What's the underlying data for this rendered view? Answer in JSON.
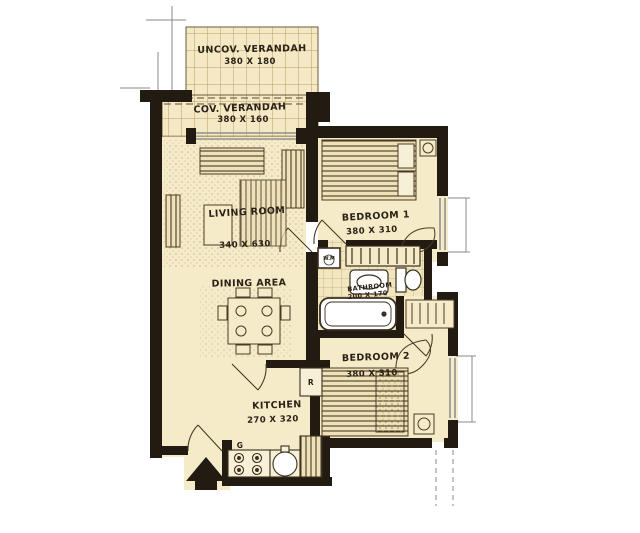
{
  "plan": {
    "type": "floor-plan",
    "style": "hand-drawn architectural sketch, one-bedroom-wing apartment unit",
    "colors": {
      "paper": "#ffffff",
      "room_fill": "#f5ebc8",
      "wall": "#211b12",
      "ink": "#4a3b26",
      "grid": "#bca06b",
      "window": "#8f8f8f"
    },
    "rooms": [
      {
        "id": "uncov_verandah",
        "name": "UNCOV. VERANDAH",
        "dims": "380 X 180"
      },
      {
        "id": "cov_verandah",
        "name": "COV. VERANDAH",
        "dims": "380 X 160"
      },
      {
        "id": "living_room",
        "name": "LIVING ROOM",
        "dims": "340 X 630"
      },
      {
        "id": "dining_area",
        "name": "DINING AREA",
        "dims": ""
      },
      {
        "id": "bedroom_1",
        "name": "BEDROOM 1",
        "dims": "380 X 310"
      },
      {
        "id": "bathroom",
        "name": "BATHROOM",
        "dims": "200 X 170"
      },
      {
        "id": "bedroom_2",
        "name": "BEDROOM 2",
        "dims": "380 X 310"
      },
      {
        "id": "kitchen",
        "name": "KITCHEN",
        "dims": "270 X 320"
      }
    ],
    "appliance_labels": {
      "washing_machine": "W.M",
      "refrigerator": "R",
      "gas_cooker": "G"
    }
  }
}
